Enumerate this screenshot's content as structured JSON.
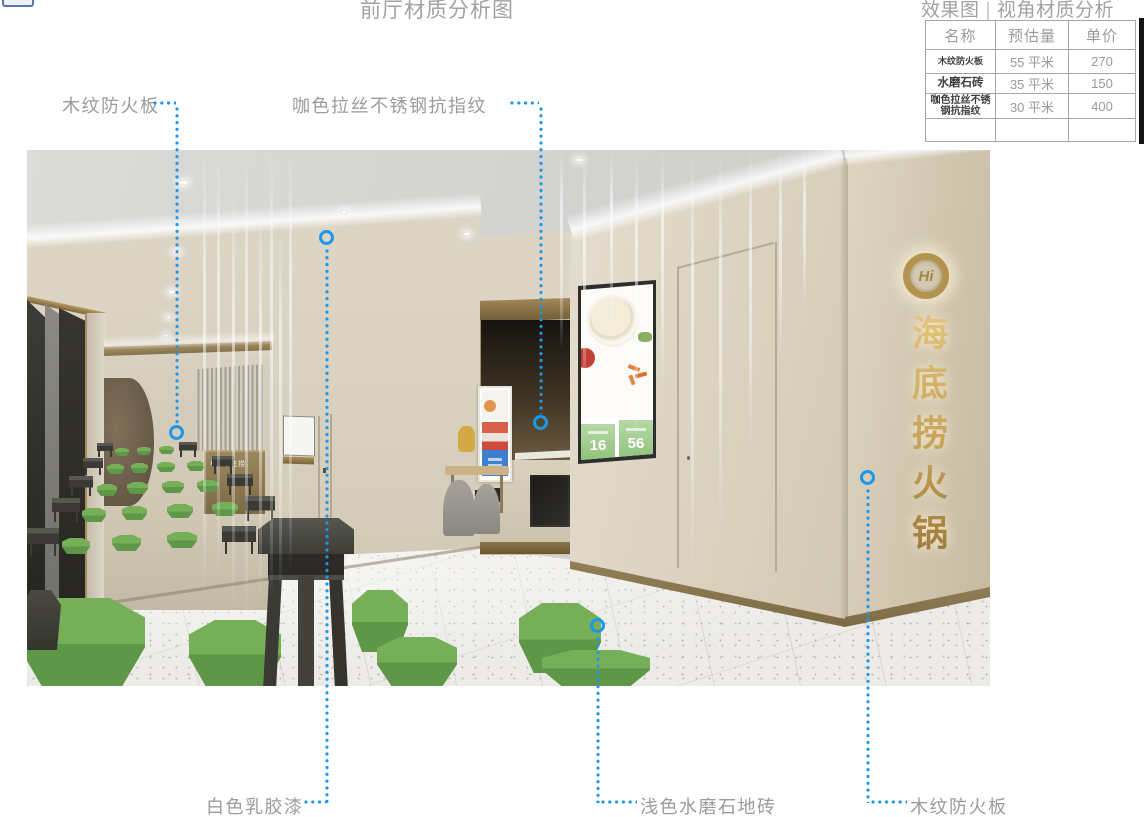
{
  "page": {
    "title": "前厅材质分析图"
  },
  "legend": {
    "heading_left": "效果图",
    "heading_sep": "|",
    "heading_right": "视角材质分析",
    "table": {
      "headers": [
        "名称",
        "预估量",
        "单价"
      ],
      "rows": [
        {
          "name": "木纹防火板",
          "qty": "55 平米",
          "price": "270"
        },
        {
          "name": "水磨石砖",
          "qty": "35 平米",
          "price": "150"
        },
        {
          "name": "咖色拉丝不锈钢抗指纹",
          "qty": "30 平米",
          "price": "400"
        },
        {
          "name": "",
          "qty": "",
          "price": ""
        }
      ]
    }
  },
  "callouts": {
    "wood_top": {
      "label": "木纹防火板"
    },
    "steel": {
      "label": "咖色拉丝不锈钢抗指纹"
    },
    "paint": {
      "label": "白色乳胶漆"
    },
    "floor": {
      "label": "浅色水磨石地砖"
    },
    "wood_right": {
      "label": "木纹防火板"
    }
  },
  "render": {
    "sign": {
      "badge": "Hi",
      "text": "海底捞火锅"
    },
    "reception": {
      "logo": "海底捞"
    },
    "menu": {
      "left_price": "16",
      "right_price": "56"
    }
  },
  "colors": {
    "accent_blue": "#1d97e9",
    "label_gray": "#9b9b9b",
    "sign_gold": "#b3944e",
    "stool_green": "#6fae53",
    "counter_khaki": "#8a7748"
  }
}
